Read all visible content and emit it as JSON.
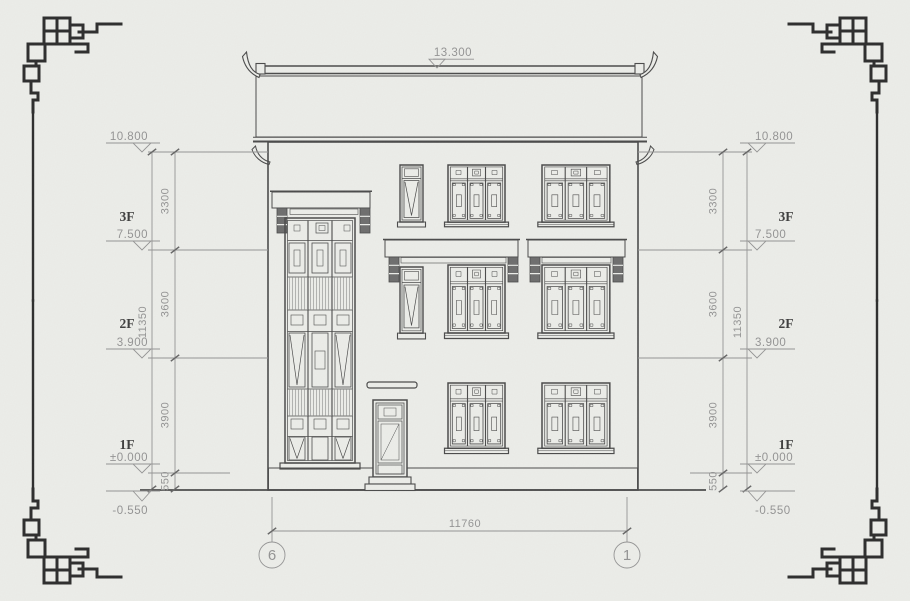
{
  "colors": {
    "paper": "#ecede9",
    "line": "#4b4b4b",
    "dim": "#949494",
    "ink": "#3e3e3e",
    "ornament": "#2d2d2d"
  },
  "annotations": {
    "ridge_elevation": "13.300",
    "eave_elevation": "10.800",
    "floors": {
      "f3": {
        "label": "3F",
        "elevation": "7.500"
      },
      "f2": {
        "label": "2F",
        "elevation": "3.900"
      },
      "f1": {
        "label": "1F",
        "elevation": "±0.000"
      }
    },
    "ground_elevation": "-0.550",
    "vertical_segments": [
      "3300",
      "3600",
      "3900",
      "550"
    ],
    "vertical_total": "11350",
    "width_total": "11760",
    "axis_left": "6",
    "axis_right": "1"
  }
}
